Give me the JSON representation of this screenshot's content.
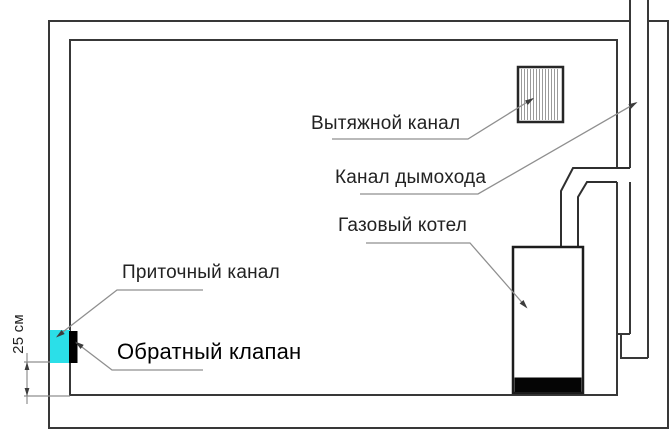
{
  "diagram": {
    "title": "Gas boiler room ventilation scheme",
    "labels": {
      "exhaust_channel": "Вытяжной канал",
      "chimney_channel": "Канал дымохода",
      "gas_boiler": "Газовый котел",
      "supply_channel": "Приточный канал",
      "check_valve": "Обратный клапан",
      "dimension_25cm": "25 см"
    },
    "colors": {
      "background": "#ffffff",
      "wall_line": "#383838",
      "pipe_line": "#2f2f2f",
      "boiler_line": "#1c1c1c",
      "leader_line": "#8f8f8f",
      "arrow_fill": "#3c3c3c",
      "hatch_line": "#9a9a9a",
      "supply_inlet_fill": "#2bdfe8",
      "check_valve_fill": "#000000",
      "boiler_base_fill": "#050505",
      "text": "#222222"
    }
  }
}
